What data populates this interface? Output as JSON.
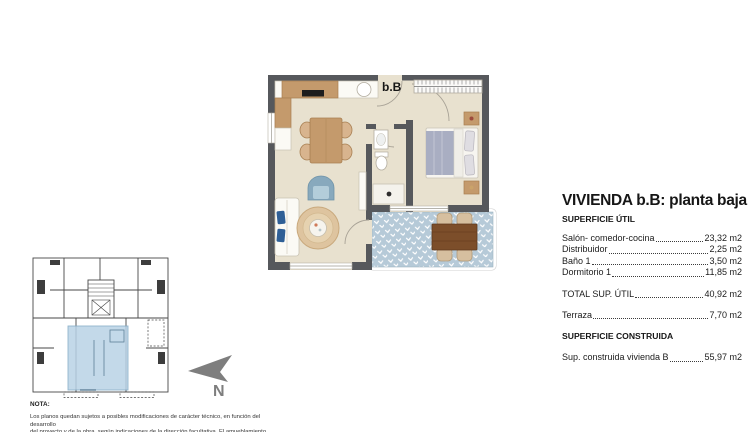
{
  "floor_plan": {
    "unit_label": "b.B"
  },
  "north": {
    "label": "N"
  },
  "title_panel": {
    "title": "VIVIENDA b.B: planta baja",
    "section_util_header": "SUPERFICIE ÚTIL",
    "rows": [
      {
        "label": "Salón- comedor-cocina",
        "value": "23,32 m2"
      },
      {
        "label": "Distribuidor",
        "value": "2,25 m2"
      },
      {
        "label": "Baño 1",
        "value": "3,50 m2"
      },
      {
        "label": "Dormitorio 1",
        "value": "11,85 m2"
      }
    ],
    "total_row": {
      "label": "TOTAL SUP. ÚTIL",
      "value": "40,92 m2"
    },
    "terraza_row": {
      "label": "Terraza",
      "value": "7,70 m2"
    },
    "section_construida_header": "SUPERFICIE CONSTRUIDA",
    "construida_row": {
      "label": "Sup. construida vivienda B",
      "value": "55,97 m2"
    }
  },
  "note": {
    "header": "NOTA:",
    "lines": [
      "Los planos quedan sujetos a posibles modificaciones de carácter técnico, en función del desarrollo",
      "del proyecto y de la obra, según indicaciones de la dirección facultativa. El amueblamiento reflejado"
    ]
  },
  "colors": {
    "wall": "#56585c",
    "floor": "#e8e1cf",
    "wood": "#c49a6c",
    "terrace_blue": "#b6cad8",
    "highlight_blue": "#b9d3e6",
    "arrow_gray": "#7e7e7e"
  }
}
